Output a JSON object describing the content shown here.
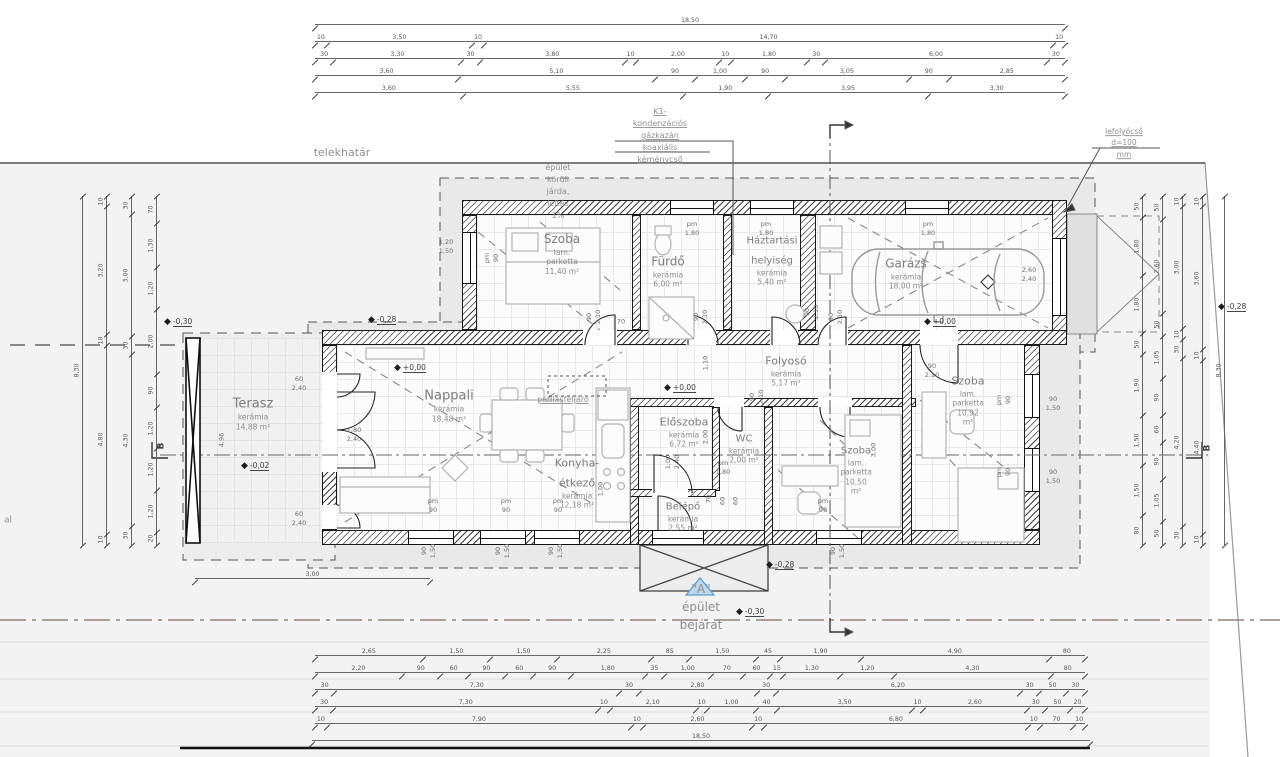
{
  "labels": {
    "telekhatar": "telekhatár",
    "jarda": "épület körüli járda, lejtés 1%",
    "kazan": "K1-kondenzációs gázkazán\nkoaxiális kéménycső",
    "lefolyocso": "lefolyócső d=100 mm",
    "padlasfeljaro": "padlásfeljáró",
    "bejarat": "\"A\" épület bejárat",
    "edge_fragment": "al"
  },
  "rooms": [
    {
      "name": "Szoba",
      "floor": "lam. parketta",
      "area": "11,40 m²",
      "x": 562,
      "y": 252,
      "fs": 12
    },
    {
      "name": "Fürdő",
      "floor": "kerámia",
      "area": "6,00 m²",
      "x": 668,
      "y": 270,
      "fs": 12
    },
    {
      "name": "Háztartási\nhelyiség",
      "floor": "kerámia",
      "area": "5,40 m²",
      "x": 772,
      "y": 258,
      "fs": 10
    },
    {
      "name": "Garázs",
      "floor": "kerámia",
      "area": "18,00 m²",
      "x": 906,
      "y": 272,
      "fs": 12
    },
    {
      "name": "Folyosó",
      "floor": "kerámia",
      "area": "5,17 m²",
      "x": 786,
      "y": 369,
      "fs": 11
    },
    {
      "name": "Terasz",
      "floor": "kerámia",
      "area": "14,88 m²",
      "x": 253,
      "y": 412,
      "fs": 13
    },
    {
      "name": "Nappali",
      "floor": "kerámia",
      "area": "18,48 m²",
      "x": 449,
      "y": 404,
      "fs": 13
    },
    {
      "name": "Előszoba",
      "floor": "kerámia",
      "area": "6,72 m²",
      "x": 684,
      "y": 430,
      "fs": 11
    },
    {
      "name": "WC",
      "floor": "kerámia",
      "area": "2,00 m²",
      "x": 744,
      "y": 446,
      "fs": 10
    },
    {
      "name": "Konyha-étkező",
      "floor": "kerámia",
      "area": "12,18 m²",
      "x": 577,
      "y": 481,
      "fs": 11
    },
    {
      "name": "Belépő",
      "floor": "kerámia",
      "area": "2,55 m²",
      "x": 683,
      "y": 514,
      "fs": 10
    },
    {
      "name": "Szoba",
      "floor": "lam. parketta",
      "area": "10,92 m²",
      "x": 968,
      "y": 398,
      "fs": 11
    },
    {
      "name": "Szoba",
      "floor": "lam. parketta",
      "area": "10,50 m²",
      "x": 856,
      "y": 467,
      "fs": 10
    }
  ],
  "annotations": [
    {
      "t": "telekhatár",
      "x": 342,
      "y": 153,
      "fs": 11
    },
    {
      "t": "épület körüli járda, lejtés 1%",
      "x": 558,
      "y": 192,
      "fs": 8
    },
    {
      "t": "K1-kondenzációs gázkazán\nkoaxiális kéménycső",
      "x": 660,
      "y": 136,
      "fs": 8,
      "u": 1
    },
    {
      "t": "lefolyócső d=100 mm",
      "x": 1124,
      "y": 143,
      "fs": 7.5,
      "u": 1
    },
    {
      "t": "padlásfeljáró",
      "x": 563,
      "y": 400,
      "fs": 8,
      "u": 1
    },
    {
      "t": "\"A\" épület bejárat",
      "x": 701,
      "y": 607,
      "fs": 12
    },
    {
      "t": "al",
      "x": 8,
      "y": 521,
      "fs": 9
    }
  ],
  "levels": [
    {
      "t": "+0,00",
      "x": 398,
      "y": 368
    },
    {
      "t": "+0,00",
      "x": 668,
      "y": 388
    },
    {
      "t": "+0,00",
      "x": 928,
      "y": 322
    },
    {
      "t": "-0,30",
      "x": 168,
      "y": 322
    },
    {
      "t": "-0,28",
      "x": 372,
      "y": 320
    },
    {
      "t": "-0,02",
      "x": 245,
      "y": 466
    },
    {
      "t": "-0,28",
      "x": 770,
      "y": 565
    },
    {
      "t": "-0,30",
      "x": 740,
      "y": 612
    },
    {
      "t": "-0,28",
      "x": 1222,
      "y": 307
    }
  ],
  "tags": [
    {
      "t": "pm 90",
      "x": 492,
      "y": 258,
      "r": 1
    },
    {
      "t": "1,20\n1,50",
      "x": 446,
      "y": 247
    },
    {
      "t": "pm 1,80",
      "x": 692,
      "y": 229
    },
    {
      "t": "pm 1,80",
      "x": 766,
      "y": 229
    },
    {
      "t": "pm 1,80",
      "x": 928,
      "y": 229
    },
    {
      "t": "90\n2,10",
      "x": 594,
      "y": 317,
      "r": 1
    },
    {
      "t": "70",
      "x": 621,
      "y": 322
    },
    {
      "t": "90\n2,10",
      "x": 701,
      "y": 317,
      "r": 1
    },
    {
      "t": "90\n2,10",
      "x": 812,
      "y": 312,
      "r": 1
    },
    {
      "t": "90\n2,10",
      "x": 836,
      "y": 317,
      "r": 1
    },
    {
      "t": "1,10",
      "x": 706,
      "y": 363,
      "r": 1
    },
    {
      "t": "90\n2,10",
      "x": 932,
      "y": 371
    },
    {
      "t": "90\n2,10",
      "x": 757,
      "y": 397,
      "r": 1
    },
    {
      "t": "2,00",
      "x": 706,
      "y": 437,
      "r": 1
    },
    {
      "t": "1,00\n2,40",
      "x": 673,
      "y": 462,
      "r": 1
    },
    {
      "t": "3,00",
      "x": 874,
      "y": 450,
      "r": 1
    },
    {
      "t": "60\n2,40",
      "x": 299,
      "y": 384
    },
    {
      "t": "1,80\n2,40",
      "x": 354,
      "y": 435
    },
    {
      "t": "60\n2,40",
      "x": 299,
      "y": 519
    },
    {
      "t": "4,96",
      "x": 222,
      "y": 440,
      "r": 1
    },
    {
      "t": "2,60\n2,40",
      "x": 1029,
      "y": 275
    },
    {
      "t": "90\n1,50",
      "x": 1053,
      "y": 404
    },
    {
      "t": "90\n1,50",
      "x": 1053,
      "y": 477
    },
    {
      "t": "pm 90",
      "x": 1004,
      "y": 400,
      "r": 1
    },
    {
      "t": "pm 90",
      "x": 1004,
      "y": 472,
      "r": 1
    },
    {
      "t": "pm 90",
      "x": 433,
      "y": 506
    },
    {
      "t": "pm 90",
      "x": 506,
      "y": 506
    },
    {
      "t": "pm 90",
      "x": 558,
      "y": 506
    },
    {
      "t": "pm 90",
      "x": 823,
      "y": 506
    },
    {
      "t": "pm 1,80",
      "x": 723,
      "y": 468
    },
    {
      "t": "90\n1,50",
      "x": 429,
      "y": 551,
      "r": 1
    },
    {
      "t": "90\n1,50",
      "x": 503,
      "y": 551,
      "r": 1
    },
    {
      "t": "90\n1,50",
      "x": 556,
      "y": 551,
      "r": 1
    },
    {
      "t": "90\n1,50",
      "x": 838,
      "y": 551,
      "r": 1
    },
    {
      "t": "70",
      "x": 709,
      "y": 499,
      "r": 1
    },
    {
      "t": "60",
      "x": 723,
      "y": 501,
      "r": 1
    },
    {
      "t": "60",
      "x": 736,
      "y": 501,
      "r": 1
    },
    {
      "t": "1,00",
      "x": 601,
      "y": 489,
      "r": 1
    },
    {
      "t": "B",
      "x": 162,
      "y": 446,
      "r": 1,
      "c": "sec"
    },
    {
      "t": "B",
      "x": 1208,
      "y": 448,
      "r": 1,
      "c": "sec"
    }
  ],
  "dims": {
    "chains": [
      {
        "x": 315,
        "y": 14,
        "l": 750,
        "o": "h",
        "s": [
          [
            "18,50",
            18.5
          ]
        ]
      },
      {
        "x": 315,
        "y": 31,
        "l": 750,
        "o": "h",
        "s": [
          [
            "10",
            0.1
          ],
          [
            "3,50",
            3.5
          ],
          [
            "10",
            0.1
          ],
          [
            "14,70",
            14.7
          ],
          [
            "10",
            0.1
          ]
        ]
      },
      {
        "x": 315,
        "y": 48,
        "l": 750,
        "o": "h",
        "s": [
          [
            "30",
            0.3
          ],
          [
            "3,30",
            3.3
          ],
          [
            "30",
            0.3
          ],
          [
            "3,80",
            3.8
          ],
          [
            "10",
            0.1
          ],
          [
            "2,00",
            2
          ],
          [
            "10",
            0.1
          ],
          [
            "1,80",
            1.8
          ],
          [
            "30",
            0.3
          ],
          [
            "6,00",
            6
          ],
          [
            "30",
            0.3
          ]
        ]
      },
      {
        "x": 315,
        "y": 65,
        "l": 750,
        "o": "h",
        "s": [
          [
            "3,60",
            3.6
          ],
          [
            "5,10",
            5.1
          ],
          [
            "90",
            0.9
          ],
          [
            "1,00",
            1
          ],
          [
            "90",
            0.9
          ],
          [
            "3,05",
            3.05
          ],
          [
            "90",
            0.9
          ],
          [
            "2,85",
            2.85
          ]
        ]
      },
      {
        "x": 315,
        "y": 82,
        "l": 750,
        "o": "h",
        "s": [
          [
            "3,60",
            3.6
          ],
          [
            "5,55",
            5.55
          ],
          [
            "1,90",
            1.9
          ],
          [
            "3,95",
            3.95
          ],
          [
            "3,30",
            3.3
          ]
        ]
      },
      {
        "x": 315,
        "y": 645,
        "l": 770,
        "o": "h",
        "s": [
          [
            "2,65",
            2.65
          ],
          [
            "1,50",
            1.5
          ],
          [
            "1,50",
            1.5
          ],
          [
            "2,25",
            2.25
          ],
          [
            "85",
            0.85
          ],
          [
            "1,50",
            1.5
          ],
          [
            "45",
            0.45
          ],
          [
            "1,90",
            1.9
          ],
          [
            "4,90",
            4.9
          ],
          [
            "80",
            0.8
          ]
        ]
      },
      {
        "x": 315,
        "y": 662,
        "l": 770,
        "o": "h",
        "s": [
          [
            "2,20",
            2.2
          ],
          [
            "90",
            0.9
          ],
          [
            "60",
            0.6
          ],
          [
            "90",
            0.9
          ],
          [
            "60",
            0.6
          ],
          [
            "90",
            0.9
          ],
          [
            "1,80",
            1.8
          ],
          [
            "35",
            0.35
          ],
          [
            "1,00",
            1
          ],
          [
            "70",
            0.7
          ],
          [
            "60",
            0.6
          ],
          [
            "15",
            0.15
          ],
          [
            "1,30",
            1.3
          ],
          [
            "1,20",
            1.2
          ],
          [
            "4,30",
            4.3
          ],
          [
            "80",
            0.8
          ]
        ]
      },
      {
        "x": 315,
        "y": 679,
        "l": 770,
        "o": "h",
        "s": [
          [
            "30",
            0.3
          ],
          [
            "7,30",
            7.3
          ],
          [
            "30",
            0.3
          ],
          [
            "2,80",
            2.8
          ],
          [
            "30",
            0.3
          ],
          [
            "6,20",
            6.2
          ],
          [
            "30",
            0.3
          ],
          [
            "50",
            0.5
          ],
          [
            "30",
            0.3
          ]
        ]
      },
      {
        "x": 315,
        "y": 696,
        "l": 770,
        "o": "h",
        "s": [
          [
            "30",
            0.3
          ],
          [
            "7,30",
            7.3
          ],
          [
            "10",
            0.1
          ],
          [
            "2,10",
            2.1
          ],
          [
            "10",
            0.1
          ],
          [
            "1,00",
            1
          ],
          [
            "40",
            0.4
          ],
          [
            "3,50",
            3.5
          ],
          [
            "10",
            0.1
          ],
          [
            "2,60",
            2.6
          ],
          [
            "30",
            0.3
          ],
          [
            "50",
            0.5
          ],
          [
            "20",
            0.2
          ]
        ]
      },
      {
        "x": 315,
        "y": 713,
        "l": 770,
        "o": "h",
        "s": [
          [
            "10",
            0.1
          ],
          [
            "7,90",
            7.9
          ],
          [
            "10",
            0.1
          ],
          [
            "2,60",
            2.6
          ],
          [
            "10",
            0.1
          ],
          [
            "6,80",
            6.8
          ],
          [
            "10",
            0.1
          ],
          [
            "70",
            0.7
          ],
          [
            "10",
            0.1
          ]
        ]
      },
      {
        "x": 312,
        "y": 730,
        "l": 778,
        "o": "h",
        "s": [
          [
            "18,50",
            18.5
          ]
        ]
      },
      {
        "x": 195,
        "y": 568,
        "l": 235,
        "o": "h",
        "s": [
          [
            "3,00",
            1
          ]
        ]
      },
      {
        "x": 72,
        "y": 196,
        "l": 349,
        "o": "v",
        "s": [
          [
            "8,30",
            8.3
          ]
        ]
      },
      {
        "x": 96,
        "y": 196,
        "l": 349,
        "o": "v",
        "s": [
          [
            "10",
            0.1
          ],
          [
            "3,20",
            3.2
          ],
          [
            "10",
            0.1
          ],
          [
            "4,80",
            4.8
          ],
          [
            "10",
            0.1
          ]
        ]
      },
      {
        "x": 121,
        "y": 196,
        "l": 349,
        "o": "v",
        "s": [
          [
            "30",
            0.3
          ],
          [
            "3,00",
            3
          ],
          [
            "30",
            0.3
          ],
          [
            "4,30",
            4.3
          ],
          [
            "30",
            0.3
          ]
        ]
      },
      {
        "x": 146,
        "y": 196,
        "l": 349,
        "o": "v",
        "s": [
          [
            "70",
            0.7
          ],
          [
            "1,30",
            1.3
          ],
          [
            "1,20",
            1.2
          ],
          [
            "2,00",
            2
          ],
          [
            "90",
            0.9
          ],
          [
            "1,20",
            1.2
          ],
          [
            "1,20",
            1.2
          ],
          [
            "1,20",
            1.2
          ],
          [
            "20",
            0.2
          ]
        ]
      },
      {
        "x": 1132,
        "y": 196,
        "l": 349,
        "o": "v",
        "s": [
          [
            "50",
            0.5
          ],
          [
            "1,80",
            1.8
          ],
          [
            "1,80",
            1.8
          ],
          [
            "50",
            0.5
          ],
          [
            "1,90",
            1.9
          ],
          [
            "1,50",
            1.5
          ],
          [
            "1,50",
            1.5
          ],
          [
            "80",
            0.8
          ]
        ]
      },
      {
        "x": 1152,
        "y": 196,
        "l": 349,
        "o": "v",
        "s": [
          [
            "50",
            0.5
          ],
          [
            "2,60",
            2.6
          ],
          [
            "50",
            0.5
          ],
          [
            "1,05",
            1.05
          ],
          [
            "90",
            0.9
          ],
          [
            "60",
            0.6
          ],
          [
            "90",
            0.9
          ],
          [
            "1,05",
            1.05
          ],
          [
            "50",
            0.5
          ]
        ]
      },
      {
        "x": 1172,
        "y": 196,
        "l": 349,
        "o": "v",
        "s": [
          [
            "10",
            0.1
          ],
          [
            "3,00",
            3
          ],
          [
            "10",
            0.1
          ],
          [
            "30",
            0.3
          ],
          [
            "4,20",
            4.2
          ],
          [
            "30",
            0.3
          ]
        ]
      },
      {
        "x": 1192,
        "y": 196,
        "l": 349,
        "o": "v",
        "s": [
          [
            "10",
            0.1
          ],
          [
            "3,60",
            3.6
          ],
          [
            "10",
            0.1
          ],
          [
            "4,40",
            4.4
          ],
          [
            "10",
            0.1
          ]
        ]
      },
      {
        "x": 1214,
        "y": 196,
        "l": 349,
        "o": "v",
        "s": [
          [
            "8,30",
            8.3
          ]
        ]
      }
    ]
  }
}
